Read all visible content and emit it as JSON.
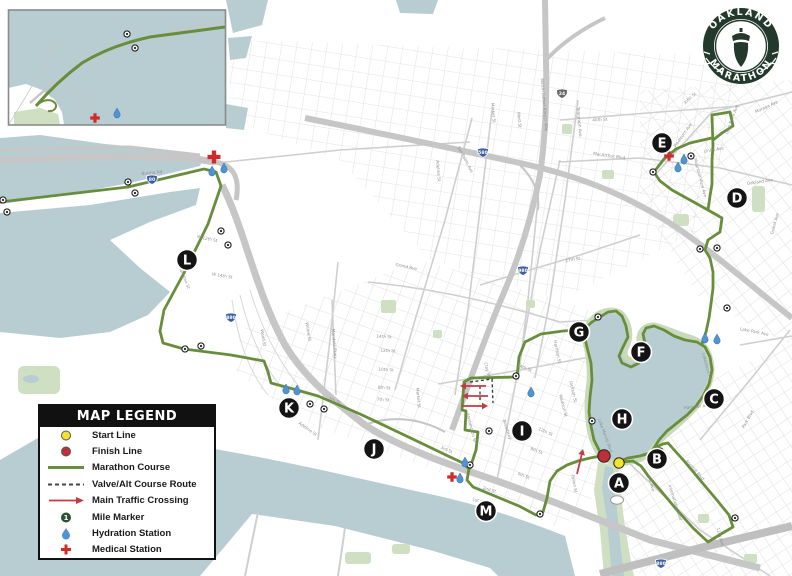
{
  "logo": {
    "top_text": "OAKLAND",
    "bottom_text": "MARATHON"
  },
  "legend": {
    "title": "MAP LEGEND",
    "mile_sample": "1",
    "items": [
      {
        "label": "Start Line"
      },
      {
        "label": "Finish Line"
      },
      {
        "label": "Marathon Course"
      },
      {
        "label": "Valve/Alt Course Route"
      },
      {
        "label": "Main Traffic Crossing"
      },
      {
        "label": "Mile Marker"
      },
      {
        "label": "Hydration Station"
      },
      {
        "label": "Medical Station"
      }
    ]
  },
  "colors": {
    "water": "#b7cdd2",
    "park": "#cfdfc2",
    "parkdark": "#b9d3a8",
    "street": "#e1e1e1",
    "major": "#cfcfcf",
    "freeway": "#c6c6c6",
    "course": "#688e3c",
    "letter": "#141414",
    "hydration": "#4f93d2",
    "medical": "#cf2b2b",
    "start": "#f2e32b",
    "finish": "#bf2f3a",
    "arrow": "#c23a42",
    "logo": "#22392b",
    "milefill": "#ffffff",
    "milering": "#222222",
    "legendmile": "#2c5234"
  },
  "start_line": {
    "x": 619,
    "y": 463
  },
  "finish_line": {
    "x": 604,
    "y": 456
  },
  "course_points": [
    {
      "id": "A",
      "x": 619,
      "y": 483
    },
    {
      "id": "B",
      "x": 657,
      "y": 459
    },
    {
      "id": "C",
      "x": 714,
      "y": 399
    },
    {
      "id": "D",
      "x": 737,
      "y": 198
    },
    {
      "id": "E",
      "x": 662,
      "y": 143
    },
    {
      "id": "F",
      "x": 641,
      "y": 352
    },
    {
      "id": "G",
      "x": 579,
      "y": 332
    },
    {
      "id": "H",
      "x": 622,
      "y": 419
    },
    {
      "id": "I",
      "x": 522,
      "y": 431
    },
    {
      "id": "J",
      "x": 374,
      "y": 449
    },
    {
      "id": "K",
      "x": 289,
      "y": 408
    },
    {
      "id": "L",
      "x": 187,
      "y": 260
    },
    {
      "id": "M",
      "x": 486,
      "y": 511
    }
  ],
  "mile_markers": [
    [
      3,
      200
    ],
    [
      7,
      212
    ],
    [
      128,
      182
    ],
    [
      135,
      193
    ],
    [
      221,
      231
    ],
    [
      228,
      245
    ],
    [
      185,
      349
    ],
    [
      201,
      346
    ],
    [
      310,
      404
    ],
    [
      324,
      409
    ],
    [
      470,
      465
    ],
    [
      489,
      431
    ],
    [
      516,
      376
    ],
    [
      592,
      421
    ],
    [
      598,
      317
    ],
    [
      653,
      172
    ],
    [
      691,
      156
    ],
    [
      700,
      249
    ],
    [
      717,
      248
    ],
    [
      727,
      308
    ],
    [
      735,
      518
    ],
    [
      660,
      451
    ],
    [
      540,
      514
    ],
    [
      127,
      34
    ],
    [
      135,
      48
    ]
  ],
  "hydration_stations": [
    [
      212,
      171
    ],
    [
      224,
      168
    ],
    [
      286,
      389
    ],
    [
      297,
      390
    ],
    [
      465,
      462
    ],
    [
      460,
      478
    ],
    [
      531,
      392
    ],
    [
      705,
      338
    ],
    [
      717,
      339
    ],
    [
      684,
      159
    ],
    [
      678,
      167
    ],
    [
      117,
      113
    ]
  ],
  "medical_stations": [
    [
      214,
      157
    ],
    [
      669,
      156
    ],
    [
      452,
      477
    ],
    [
      95,
      118
    ]
  ],
  "traffic_arrows": [
    {
      "x1": 486,
      "y1": 386,
      "x2": 460,
      "y2": 386
    },
    {
      "x1": 488,
      "y1": 396,
      "x2": 462,
      "y2": 396
    },
    {
      "x1": 462,
      "y1": 406,
      "x2": 488,
      "y2": 406
    },
    {
      "x1": 577,
      "y1": 474,
      "x2": 583,
      "y2": 449
    }
  ],
  "highway_shields": [
    {
      "n": "80",
      "x": 152,
      "y": 179
    },
    {
      "n": "880",
      "x": 231,
      "y": 317
    },
    {
      "n": "580",
      "x": 483,
      "y": 152
    },
    {
      "n": "980",
      "x": 523,
      "y": 270
    },
    {
      "n": "24",
      "x": 562,
      "y": 93
    },
    {
      "n": "880",
      "x": 661,
      "y": 563
    }
  ],
  "street_labels": [
    {
      "t": "Burma Rd",
      "x": 152,
      "y": 174,
      "r": -5
    },
    {
      "t": "Maritime St",
      "x": 183,
      "y": 278,
      "r": 68
    },
    {
      "t": "W 14th St",
      "x": 222,
      "y": 277,
      "r": 10
    },
    {
      "t": "W 12th St",
      "x": 207,
      "y": 240,
      "r": 12
    },
    {
      "t": "7th St",
      "x": 334,
      "y": 402,
      "r": 22
    },
    {
      "t": "3rd St",
      "x": 446,
      "y": 451,
      "r": 24
    },
    {
      "t": "2nd St",
      "x": 489,
      "y": 491,
      "r": 16
    },
    {
      "t": "1st St",
      "x": 478,
      "y": 502,
      "r": 15
    },
    {
      "t": "Adeline St",
      "x": 307,
      "y": 430,
      "r": 35
    },
    {
      "t": "Mandela Pkwy",
      "x": 333,
      "y": 344,
      "r": 85
    },
    {
      "t": "Wood St",
      "x": 262,
      "y": 338,
      "r": 80
    },
    {
      "t": "Willow St",
      "x": 307,
      "y": 332,
      "r": 80
    },
    {
      "t": "Market St",
      "x": 417,
      "y": 398,
      "r": 85
    },
    {
      "t": "Market St",
      "x": 492,
      "y": 113,
      "r": 85
    },
    {
      "t": "West St",
      "x": 518,
      "y": 120,
      "r": 85
    },
    {
      "t": "Martin Luther King Jr Way",
      "x": 543,
      "y": 105,
      "r": 85
    },
    {
      "t": "Telegraph Ave",
      "x": 578,
      "y": 122,
      "r": 85
    },
    {
      "t": "40th St",
      "x": 600,
      "y": 121,
      "r": -3
    },
    {
      "t": "MacArthur Blvd",
      "x": 609,
      "y": 157,
      "r": 8
    },
    {
      "t": "San Pablo Ave",
      "x": 464,
      "y": 160,
      "r": 62
    },
    {
      "t": "Adeline St",
      "x": 437,
      "y": 171,
      "r": 85
    },
    {
      "t": "Grand Ave",
      "x": 406,
      "y": 268,
      "r": 12
    },
    {
      "t": "27th St",
      "x": 573,
      "y": 261,
      "r": -10
    },
    {
      "t": "Broadway",
      "x": 506,
      "y": 430,
      "r": 72
    },
    {
      "t": "Washington St",
      "x": 470,
      "y": 428,
      "r": 75
    },
    {
      "t": "Clay St",
      "x": 486,
      "y": 370,
      "r": 75
    },
    {
      "t": "Madison St",
      "x": 562,
      "y": 406,
      "r": 75
    },
    {
      "t": "Jackson St",
      "x": 572,
      "y": 392,
      "r": 78
    },
    {
      "t": "Harrison St",
      "x": 556,
      "y": 352,
      "r": 78
    },
    {
      "t": "Fallon St",
      "x": 573,
      "y": 484,
      "r": 80
    },
    {
      "t": "Lake Merritt Blvd",
      "x": 604,
      "y": 436,
      "r": 70
    },
    {
      "t": "Foothill Blvd",
      "x": 694,
      "y": 471,
      "r": 48
    },
    {
      "t": "International Blvd",
      "x": 674,
      "y": 503,
      "r": 72
    },
    {
      "t": "1st Ave",
      "x": 650,
      "y": 484,
      "r": 75
    },
    {
      "t": "11th Ave",
      "x": 719,
      "y": 537,
      "r": 75
    },
    {
      "t": "Lakeshore Ave",
      "x": 706,
      "y": 368,
      "r": 75
    },
    {
      "t": "Lake Park Ave",
      "x": 754,
      "y": 333,
      "r": 12
    },
    {
      "t": "Hanover Ave",
      "x": 697,
      "y": 408,
      "r": -5
    },
    {
      "t": "Park Blvd",
      "x": 749,
      "y": 420,
      "r": -60
    },
    {
      "t": "Piedmont Ave",
      "x": 684,
      "y": 136,
      "r": -55
    },
    {
      "t": "Linda Ave",
      "x": 714,
      "y": 151,
      "r": -10
    },
    {
      "t": "Moraga Ave",
      "x": 767,
      "y": 108,
      "r": -25
    },
    {
      "t": "Glen Eden Ave",
      "x": 733,
      "y": 120,
      "r": -70
    },
    {
      "t": "John St",
      "x": 691,
      "y": 99,
      "r": -40
    },
    {
      "t": "Oakland Ave",
      "x": 760,
      "y": 183,
      "r": -8
    },
    {
      "t": "Grand Ave",
      "x": 776,
      "y": 224,
      "r": -75
    },
    {
      "t": "Mountain View Ave",
      "x": 699,
      "y": 178,
      "r": 75
    },
    {
      "t": "14th St",
      "x": 384,
      "y": 338,
      "r": 3
    },
    {
      "t": "12th St",
      "x": 388,
      "y": 352,
      "r": 3
    },
    {
      "t": "10th St",
      "x": 386,
      "y": 371,
      "r": 3
    },
    {
      "t": "8th St",
      "x": 384,
      "y": 389,
      "r": 3
    },
    {
      "t": "7th St",
      "x": 383,
      "y": 401,
      "r": 3
    },
    {
      "t": "14th St",
      "x": 524,
      "y": 369,
      "r": 22
    },
    {
      "t": "12th St",
      "x": 545,
      "y": 433,
      "r": 24
    },
    {
      "t": "9th St",
      "x": 536,
      "y": 452,
      "r": 22
    },
    {
      "t": "5th St",
      "x": 523,
      "y": 477,
      "r": 22
    }
  ]
}
